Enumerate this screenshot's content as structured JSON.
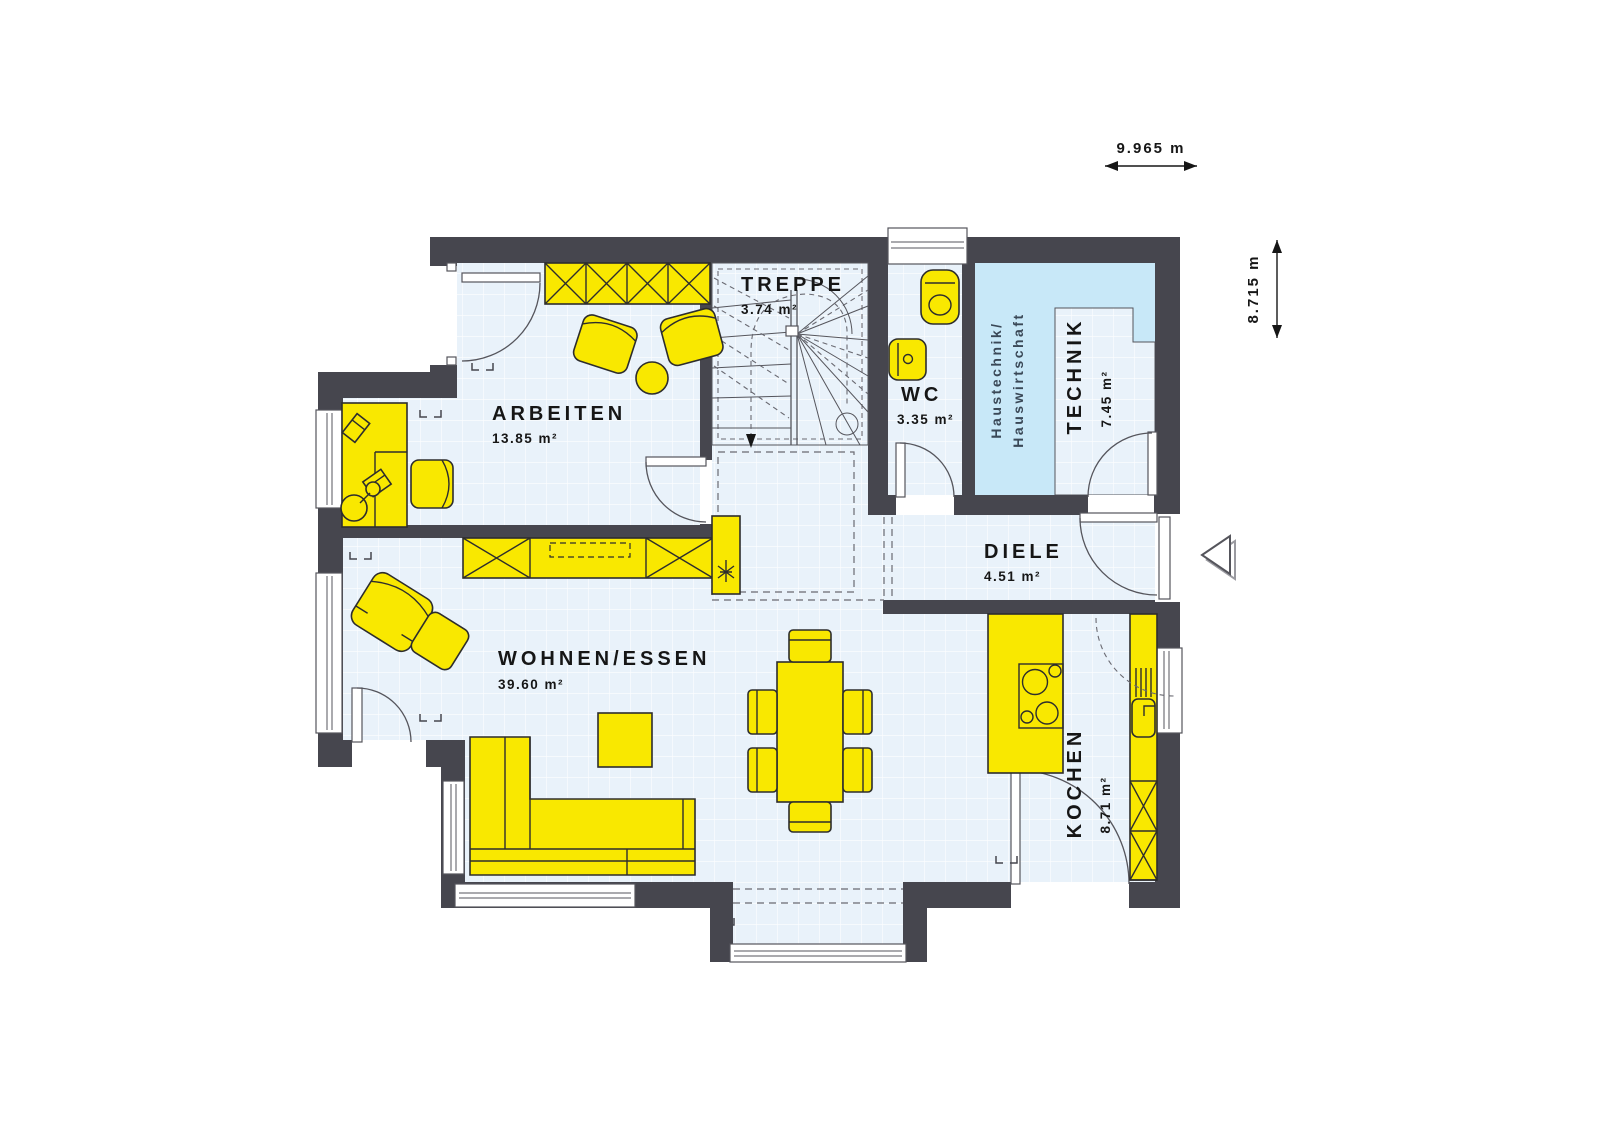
{
  "canvas": {
    "width": 1600,
    "height": 1132,
    "background": "#ffffff"
  },
  "colors": {
    "wall": "#46464e",
    "floor": "#e9f2fa",
    "floor_grid": "#fdfeff",
    "utility_room_fill": "#c8e8f8",
    "furniture": "#f9e800",
    "line": "#55555c",
    "text": "#161616",
    "utility_text": "#3a4857"
  },
  "dimensions": {
    "width": "9.965 m",
    "height": "8.715 m"
  },
  "rooms": {
    "arbeiten": {
      "name": "ARBEITEN",
      "area": "13.85 m²"
    },
    "treppe": {
      "name": "TREPPE",
      "area": "3.74 m²"
    },
    "wc": {
      "name": "WC",
      "area": "3.35 m²"
    },
    "technik": {
      "name": "TECHNIK",
      "area": "7.45 m²"
    },
    "utility": {
      "line1": "Haustechnik/",
      "line2": "Hauswirtschaft"
    },
    "diele": {
      "name": "DIELE",
      "area": "4.51 m²"
    },
    "wohnen": {
      "name": "WOHNEN/ESSEN",
      "area": "39.60 m²"
    },
    "kochen": {
      "name": "KOCHEN",
      "area": "8.71 m²"
    }
  }
}
